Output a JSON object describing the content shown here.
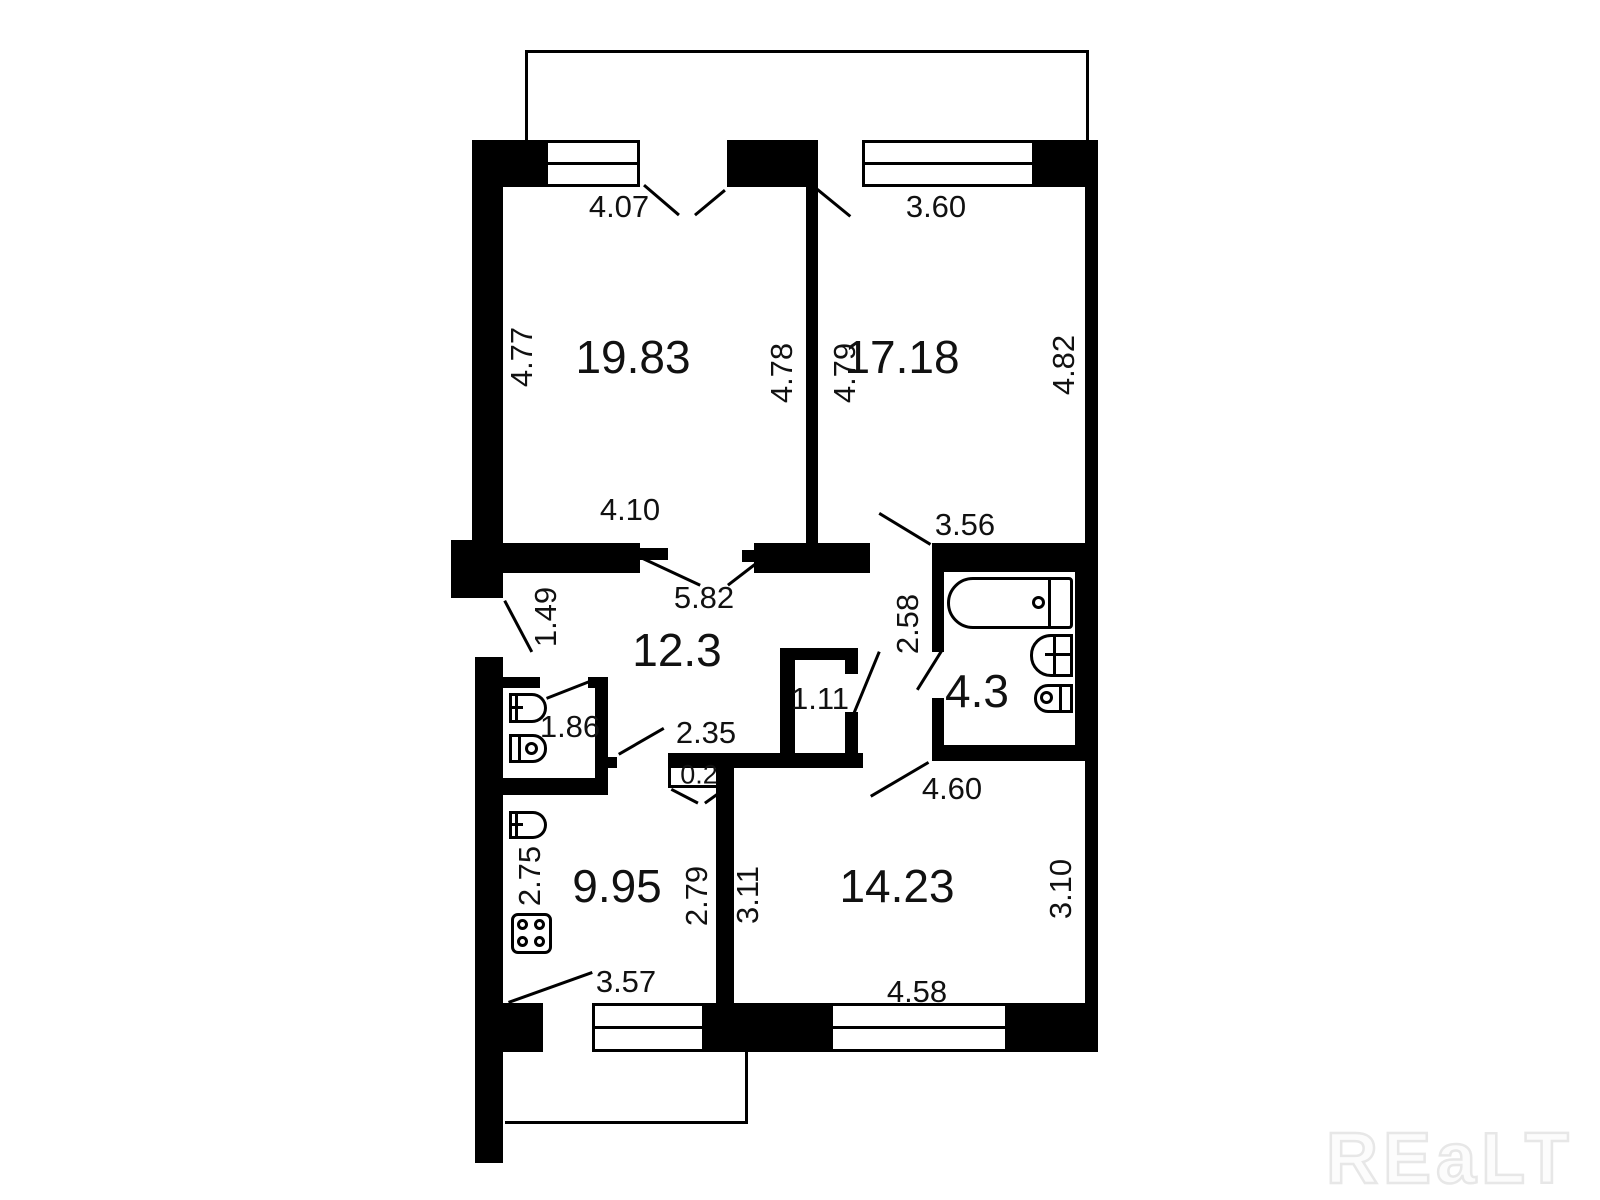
{
  "plan_type": "apartment-floor-plan",
  "watermark": "REaLT",
  "areas": {
    "living_room": "19.83",
    "bedroom": "17.18",
    "hallway": "12.3",
    "bathroom": "4.3",
    "wc": "1.86",
    "closet": "1.11",
    "kitchen": "9.95",
    "second_room": "14.23"
  },
  "dims": {
    "living_window": "4.07",
    "bedroom_window": "3.60",
    "living_left": "4.77",
    "living_right": "4.78",
    "bedroom_left": "4.79",
    "bedroom_right": "4.82",
    "living_bottom": "4.10",
    "bedroom_bottom": "3.56",
    "hallway_top": "5.82",
    "entry_width": "1.49",
    "bathroom_depth": "2.58",
    "hallway_width": "2.35",
    "wall_notch": "0.2",
    "second_room_top": "4.60",
    "kitchen_left": "2.75",
    "kitchen_right": "2.79",
    "second_room_left": "3.11",
    "second_room_right": "3.10",
    "kitchen_bottom": "3.57",
    "second_room_bottom": "4.58"
  }
}
